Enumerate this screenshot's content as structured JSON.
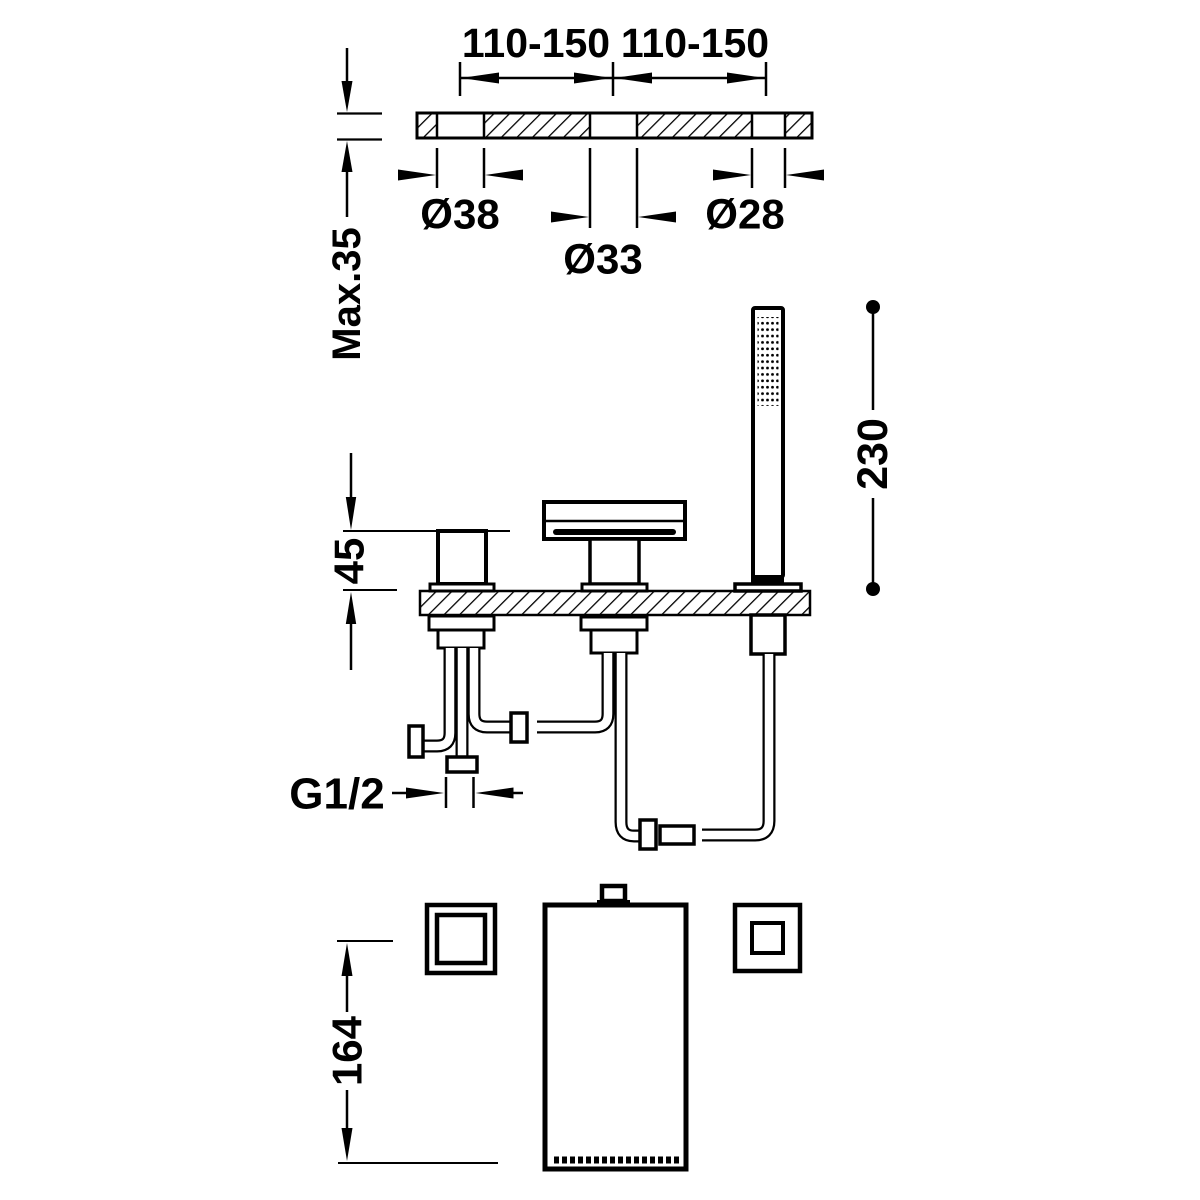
{
  "diagram": {
    "type": "technical-installation-drawing",
    "subject": "3-hole deck-mounted bath mixer with spout and handshower",
    "background_color": "#ffffff",
    "line_color": "#000000",
    "views": {
      "top": "deck cross-section with three mounting holes",
      "side": "mixer handle, cascade spout and handshower on deck with under-deck piping",
      "bottom": "plan views of handle, handshower front and shower base"
    },
    "labels": {
      "hole_spacing_left": "110-150",
      "hole_spacing_right": "110-150",
      "handle_hole_diameter": "Ø38",
      "spout_hole_diameter": "Ø33",
      "shower_hole_diameter": "Ø28",
      "max_deck_thickness": "Max.35",
      "handle_height_above_deck": "45",
      "handshower_overall_height": "230",
      "inlet_thread_size": "G1/2",
      "handshower_length": "164"
    }
  }
}
